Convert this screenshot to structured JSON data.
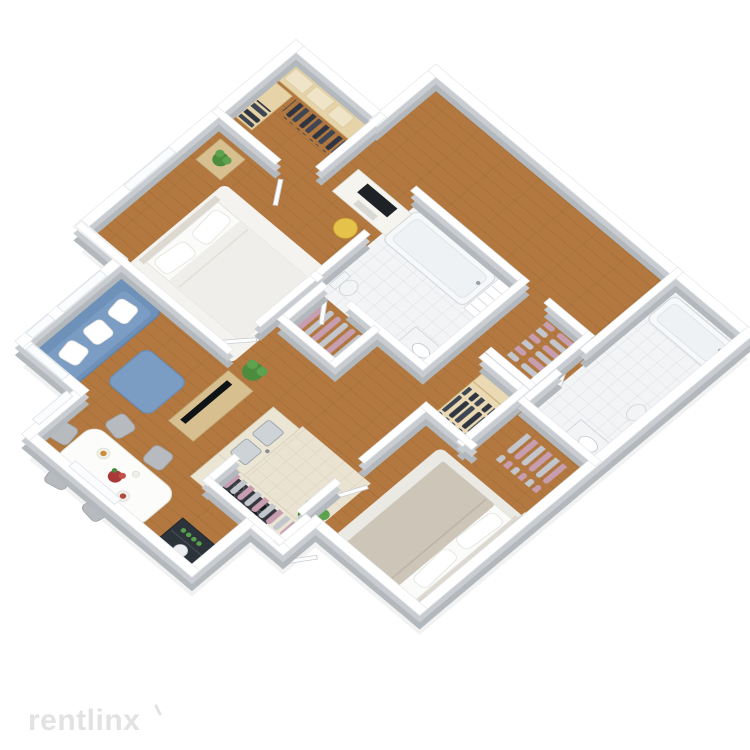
{
  "watermark": {
    "brand": "rentlinx"
  },
  "scene": {
    "type": "isometric-3d-floor-plan",
    "description": "3D isometric cutaway floor plan of a two-bedroom, two-bathroom apartment with open living/dining/kitchen area, rendered on a white background",
    "rooms": [
      {
        "name": "walk-in-closet",
        "floor": "hardwood",
        "items": [
          "wood shelving",
          "storage boxes",
          "dark hanging clothes"
        ]
      },
      {
        "name": "bedroom-1",
        "floor": "hardwood with white rug",
        "items": [
          "double bed with white bedding",
          "nightstand",
          "potted plant",
          "desk with monitor",
          "yellow chair"
        ]
      },
      {
        "name": "bathroom-1",
        "floor": "white tile",
        "items": [
          "bathtub",
          "linen shelves",
          "vanity sink",
          "toilet"
        ]
      },
      {
        "name": "hall-closets",
        "floor": "hardwood",
        "items": [
          "closet with pink and gray hanging clothes",
          "second closet with pink and gray hanging clothes",
          "wardrobe with shelves and dark clothes"
        ]
      },
      {
        "name": "living-room",
        "floor": "hardwood",
        "items": [
          "blue sofa with white pillows",
          "blue ottoman",
          "TV console with flat TV",
          "potted plant",
          "windows"
        ]
      },
      {
        "name": "dining-area",
        "floor": "hardwood",
        "items": [
          "white dining table",
          "gray chairs",
          "red flower centerpiece",
          "place settings",
          "dark cabinet with green bottles"
        ]
      },
      {
        "name": "kitchen",
        "floor": "hardwood",
        "items": [
          "L-shaped beige counter",
          "double sink",
          "four-burner gas cooktop",
          "potted plant"
        ]
      },
      {
        "name": "entry",
        "floor": "beige tile",
        "items": [
          "coat closet with pink and gray hanging clothes",
          "front door"
        ]
      },
      {
        "name": "bedroom-2-master",
        "floor": "hardwood with light rug",
        "items": [
          "large bed with taupe duvet and white pillows",
          "two nightstands with lamps",
          "closet with pink hanging clothes"
        ]
      },
      {
        "name": "bathroom-2-master",
        "floor": "white tile",
        "items": [
          "bathtub",
          "toilet",
          "vanity sink"
        ]
      }
    ],
    "palette": {
      "wood": "#b2783f",
      "wood_seam": "#9a6734",
      "wall_top": "#ffffff",
      "wall_side": "#c9cdd2",
      "wall_base": "#b3b8bd",
      "tile_white": "#f3f4f6",
      "tile_beige": "#eae3d2",
      "sofa_blue": "#6e91ba",
      "ottoman_blue": "#7b9cc3",
      "counter_beige": "#ebe5d3",
      "stove_dark": "#33373d",
      "cabinet_dark": "#2d333b",
      "bottle_green": "#57a04a",
      "plant_green": "#4c8c3f",
      "plant_light": "#5ea14f",
      "chair_yellow": "#e5c249",
      "chair_gray": "#b7bbc0",
      "clothes_pink": "#c79db0",
      "clothes_gray": "#c3c6cc",
      "clothes_dark": "#2e3541",
      "duvet_taupe": "#cdc5b8",
      "flower_red": "#a93a38",
      "watermark_gray": "#e2e2e2"
    }
  }
}
